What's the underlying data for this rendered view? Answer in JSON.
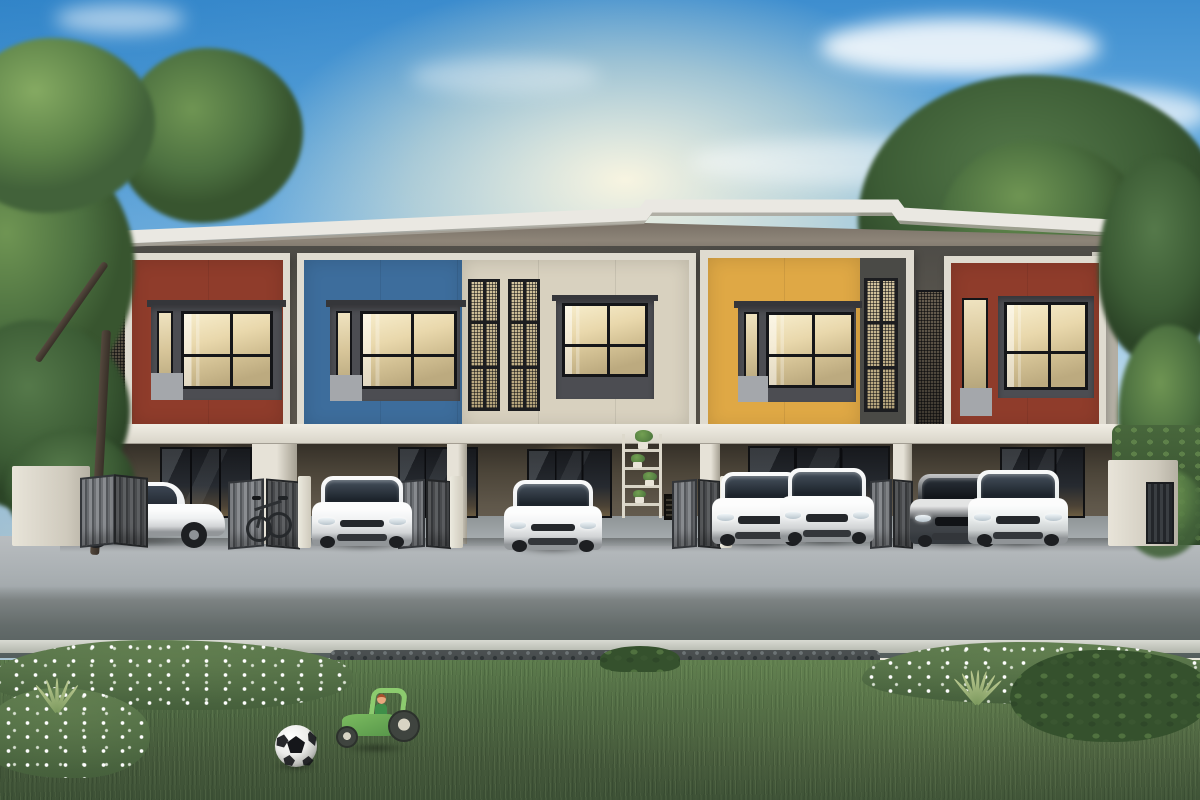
{
  "scene": {
    "title": "Row of five modern two-storey townhouses — daytime architectural rendering",
    "setting": "clear blue sky with soft clouds, large trees at both ends, carports with parked cars, road and lawn in the foreground",
    "building": {
      "storeys": 2,
      "units": [
        {
          "position": 1,
          "panel": "red",
          "panel_color": "#8f3c2b"
        },
        {
          "position": 2,
          "panel": "blue",
          "panel_color": "#3d6d9c"
        },
        {
          "position": 3,
          "panel": "cream",
          "panel_color": "#d8d1bf"
        },
        {
          "position": 4,
          "panel": "yellow",
          "panel_color": "#dfa845"
        },
        {
          "position": 5,
          "panel": "red",
          "panel_color": "#8f3c2b"
        }
      ],
      "features": [
        "flat white roof slab",
        "cream projecting window frames",
        "dark grey window bands",
        "perforated black metal screen shutters",
        "ground-floor carports with glass sliding doors",
        "grey folding carport gates",
        "white gate piers",
        "wall plant shelf with potted plants",
        "vent grille"
      ]
    },
    "vehicles": [
      {
        "slot": 1,
        "type": "sedan",
        "color_name": "white",
        "color": "#eef0f1",
        "view": "three-quarter front-left"
      },
      {
        "slot": 2,
        "type": "hatchback",
        "color_name": "white",
        "color": "#eef0f1",
        "view": "front"
      },
      {
        "slot": 3,
        "type": "hatchback",
        "color_name": "white",
        "color": "#eef0f1",
        "view": "front"
      },
      {
        "slot": 4,
        "type": "sedan",
        "color_name": "white",
        "color": "#f0f2f2",
        "view": "front"
      },
      {
        "slot": 5,
        "type": "hatchback",
        "color_name": "white",
        "color": "#eef0f1",
        "view": "front"
      },
      {
        "slot": 6,
        "type": "sedan",
        "color_name": "dark grey",
        "color": "#43474b",
        "view": "front"
      },
      {
        "slot": 7,
        "type": "hatchback",
        "color_name": "silver white",
        "color": "#e9eded",
        "view": "front"
      }
    ],
    "props": {
      "bicycle": {
        "location": "carport 2, leaning on wall"
      },
      "soccer_ball": {
        "colors": [
          "white",
          "black"
        ],
        "location": "front lawn left of centre"
      },
      "toy_tractor": {
        "color": "#6cae54",
        "location": "front lawn centre",
        "has_driver_figure": true
      }
    },
    "landscape": {
      "foreground": [
        "light concrete driveway",
        "grey asphalt road",
        "light curb",
        "dark gravel strip",
        "white-flower shrub beds",
        "trimmed hedge",
        "spiky accent plants",
        "green lawn"
      ],
      "trees": {
        "left": "large leafy tree overhanging roof",
        "right": "tall tree cluster behind building"
      }
    },
    "palette": {
      "skyTop": "#3e8ecf",
      "skyMid": "#8fc3e8",
      "skyHorizon": "#efe9d9",
      "roofWhite": "#eae8e2",
      "frameCream": "#dfdbd0",
      "wallDark": "#57554f",
      "windowModule": "#4c4d52",
      "accentGray": "#a4a7ab",
      "glassWarm": "#e9d8ac",
      "meshBase": "#d3c49e",
      "gfWall": "#5f574a",
      "drive": "#b9bdc0",
      "road": "#646c6b",
      "curb": "#d8dad2",
      "gravel": "#4b5051",
      "grass": "#4f6a43",
      "bedGreen": "#5d7a4e",
      "flowerWhite": "#ffffff",
      "gateGray": "#8a8d91",
      "postWhite": "#eceadf",
      "treeMid": "#4c7040",
      "ballWhite": "#f2f2f0",
      "ballBlack": "#15161a",
      "tractorGreen": "#7cbc60",
      "carWhite": "#edf0f1",
      "carDark": "#43474b"
    }
  }
}
